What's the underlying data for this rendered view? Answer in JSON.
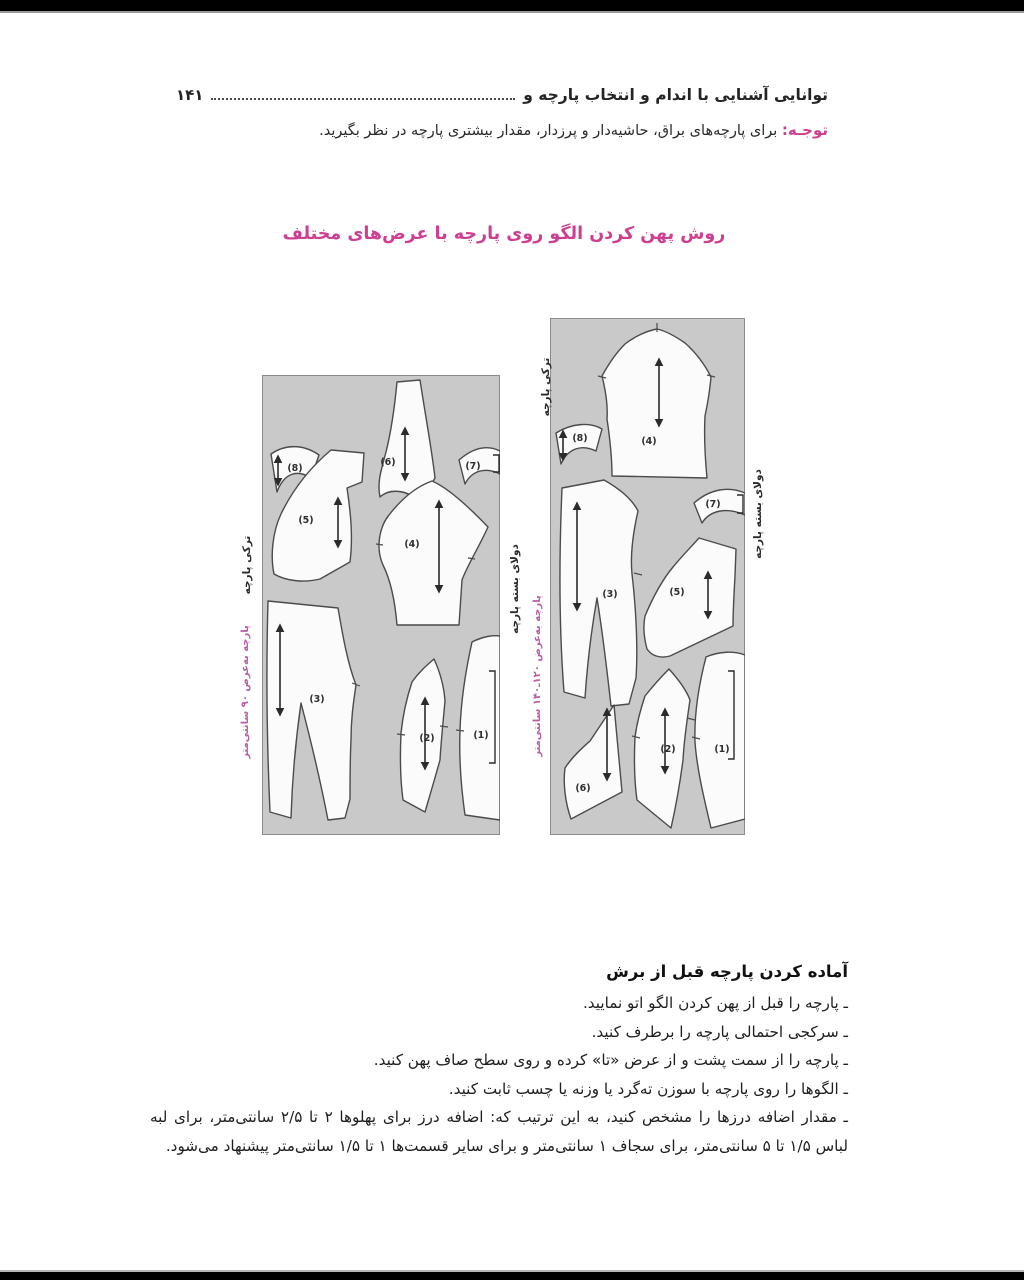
{
  "header": {
    "title": "توانایی آشنایی با اندام و انتخاب پارچه و",
    "page_number": "۱۴۱"
  },
  "note": {
    "label": "توجـه:",
    "text": "برای پارچه‌های براق، حاشیه‌دار و پرزدار، مقدار بیشتری پارچه در نظر بگیرید."
  },
  "figure_title": "روش پهن کردن الگو روی پارچه با عرض‌های مختلف",
  "diagram": {
    "panels": [
      {
        "id": "fabric-90cm",
        "selvage_label": "ترکی پارچه",
        "fold_label": "دولای بسته پارچه",
        "width_label": "پارچه به‌عرض ۹۰ سانتی‌متر",
        "pieces": {
          "p1": "(1)",
          "p2": "(2)",
          "p3": "(3)",
          "p4": "(4)",
          "p5": "(5)",
          "p6": "(6)",
          "p7": "(7)",
          "p8": "(8)"
        }
      },
      {
        "id": "fabric-120-140cm",
        "selvage_label": "ترکی پارچه",
        "fold_label": "دولای بسته پارچه",
        "width_label": "پارچه به‌عرض ۱۲۰ـ۱۴۰ سانتی‌متر",
        "pieces": {
          "p1": "(1)",
          "p2": "(2)",
          "p3": "(3)",
          "p4": "(4)",
          "p5": "(5)",
          "p6": "(6)",
          "p7": "(7)",
          "p8": "(8)"
        }
      }
    ]
  },
  "prep": {
    "heading": "آماده کردن پارچه قبل از برش",
    "bullets": [
      "ـ پارچه را قبل از پهن کردن الگو اتو نمایید.",
      "ـ سرکجی احتمالی پارچه را برطرف کنید.",
      "ـ پارچه را از سمت پشت و از عرض «تا» کرده و روی سطح صاف پهن کنید.",
      "ـ الگوها را روی پارچه با سوزن ته‌گرد یا وزنه یا چسب ثابت کنید.",
      "ـ مقدار اضافه درزها را مشخص کنید، به این ترتیب که: اضافه درز برای پهلوها ۲ تا ۲/۵ سانتی‌متر، برای لبه لباس ۱/۵ تا ۵ سانتی‌متر، برای سجاف ۱ سانتی‌متر و برای سایر قسمت‌ها ۱ تا ۱/۵ سانتی‌متر پیشنهاد می‌شود."
    ]
  },
  "colors": {
    "accent_magenta": "#ce3f92",
    "label_purple": "#b95da5",
    "fabric_gray": "#c9c9c9",
    "text": "#1f1f1f"
  }
}
